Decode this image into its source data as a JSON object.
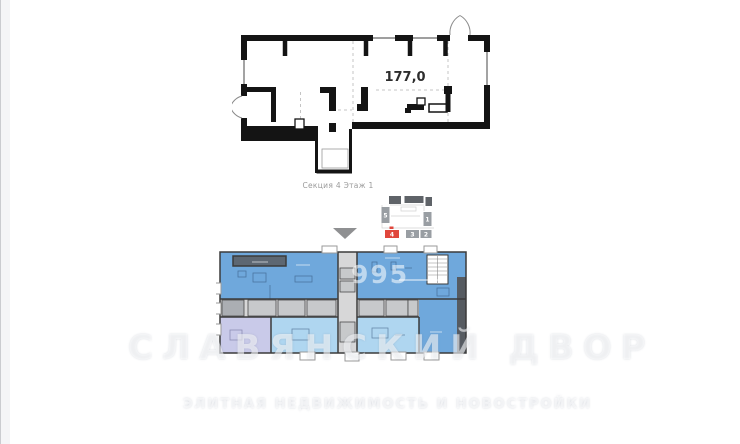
{
  "detail_plan": {
    "area_label": "177,0"
  },
  "section_selector": {
    "caption": "Секция 4 Этаж 1",
    "sections": [
      {
        "number": "5",
        "selected": false
      },
      {
        "number": "1",
        "selected": false
      },
      {
        "number": "4",
        "selected": true
      },
      {
        "number": "3",
        "selected": false
      },
      {
        "number": "2",
        "selected": false
      }
    ]
  },
  "watermark": {
    "phone_fragment": "995",
    "title": "СЛАВЯНСКИЙ ДВОР",
    "subtitle": "ЭЛИТНАЯ НЕДВИЖИМОСТЬ И НОВОСТРОЙКИ"
  },
  "colors": {
    "wall": "#141414",
    "thin_wall": "#3b3b3b",
    "blue_mid": "#6FA8DC",
    "blue_light": "#AFD6F0",
    "lavender": "#C9CAE9",
    "corridor": "#D7D7D8",
    "terrace_dark": "#5D6772",
    "strip_dark": "#565B61",
    "red": "#E0463C",
    "block_gray": "#999EA3",
    "block_dark": "#5F6368"
  }
}
